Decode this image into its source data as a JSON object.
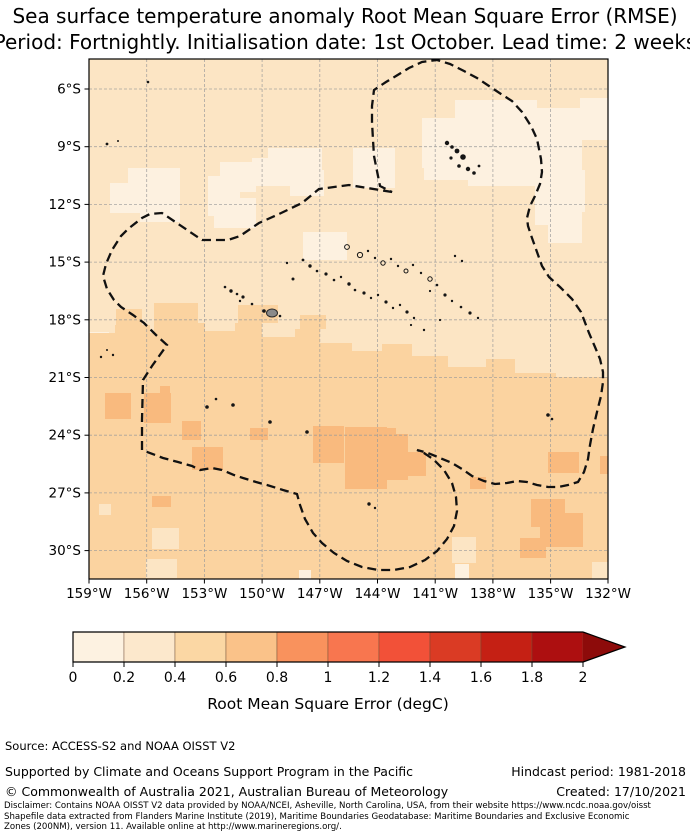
{
  "title": {
    "line1": "Sea surface temperature anomaly Root Mean Square Error (RMSE)",
    "line2": "Period: Fortnightly. Initialisation date: 1st October. Lead time: 2 weeks"
  },
  "map": {
    "x_tick_labels": [
      "159°W",
      "156°W",
      "153°W",
      "150°W",
      "147°W",
      "144°W",
      "141°W",
      "138°W",
      "135°W",
      "132°W"
    ],
    "y_tick_labels": [
      "6°S",
      "9°S",
      "12°S",
      "15°S",
      "18°S",
      "21°S",
      "24°S",
      "27°S",
      "30°S"
    ]
  },
  "map_colors": {
    "bin00_02": "#fdf1e0",
    "bin02_04": "#fce5c4",
    "bin04_06": "#fbd3a0",
    "bin06_08": "#f9ba7e",
    "eez": "#111111",
    "island": "#151515",
    "land_grey": "#8a8a8a"
  },
  "colorbar": {
    "tick_labels": [
      "0",
      "0.2",
      "0.4",
      "0.6",
      "0.8",
      "1",
      "1.2",
      "1.4",
      "1.6",
      "1.8",
      "2"
    ],
    "label": "Root Mean Square Error (degC)",
    "segment_colors": [
      "#fdf2e1",
      "#fce8cc",
      "#fbd7a4",
      "#fac289",
      "#f9925d",
      "#f8764f",
      "#f25138",
      "#da3b24",
      "#c52014",
      "#ad0f10"
    ],
    "arrow_color": "#8d0b0a"
  },
  "chart_data": {
    "type": "heatmap",
    "title": "Sea surface temperature anomaly Root Mean Square Error (RMSE)",
    "subtitle": "Period: Fortnightly. Initialisation date: 1st October. Lead time: 2 weeks",
    "x": {
      "label_ticks": [
        "159°W",
        "156°W",
        "153°W",
        "150°W",
        "147°W",
        "144°W",
        "141°W",
        "138°W",
        "135°W",
        "132°W"
      ],
      "range_deg_west": [
        159,
        132
      ]
    },
    "y": {
      "label_ticks": [
        "6°S",
        "9°S",
        "12°S",
        "15°S",
        "18°S",
        "21°S",
        "24°S",
        "27°S",
        "30°S"
      ],
      "range_deg_south": [
        4.5,
        31.5
      ]
    },
    "grid": "on, 3-degree dashed graticule",
    "colorbar": {
      "label": "Root Mean Square Error (degC)",
      "min": 0,
      "max": 2,
      "step": 0.2,
      "extend": "max",
      "position": "bottom"
    },
    "values_summary": [
      {
        "region": "northern half of domain (approx 4.5S-19S)",
        "rmse_degC": [
          0.2,
          0.4
        ]
      },
      {
        "region": "scattered patches in north and around Marquesas",
        "rmse_degC": [
          0.0,
          0.2
        ]
      },
      {
        "region": "southern half of domain (approx 19S-31.5S)",
        "rmse_degC": [
          0.4,
          0.6
        ]
      },
      {
        "region": "scattered patches in south (approx 21S-29S)",
        "rmse_degC": [
          0.6,
          0.8
        ]
      }
    ],
    "overlays": [
      "French Polynesia EEZ (200NM) dashed boundary",
      "island land points (Society, Tuamotu, Marquesas, Austral, Gambier groups; Tahiti shaded grey)"
    ]
  },
  "footer": {
    "source": "Source: ACCESS-S2 and NOAA OISST V2",
    "supported": "Supported by Climate and Oceans Support Program in the Pacific",
    "copyright": "© Commonwealth of Australia 2021, Australian Bureau of Meteorology",
    "hindcast": "Hindcast period: 1981-2018",
    "created": "Created: 17/10/2021",
    "disclaimer_line1": "Disclaimer: Contains NOAA OISST V2 data provided by NOAA/NCEI, Asheville, North Carolina, USA, from their website https://www.ncdc.noaa.gov/oisst",
    "disclaimer_line2": "Shapefile data extracted from Flanders Marine Institute (2019), Maritime Boundaries Geodatabase: Maritime Boundaries and Exclusive Economic",
    "disclaimer_line3": "Zones (200NM), version 11. Available online at http://www.marineregions.org/."
  }
}
